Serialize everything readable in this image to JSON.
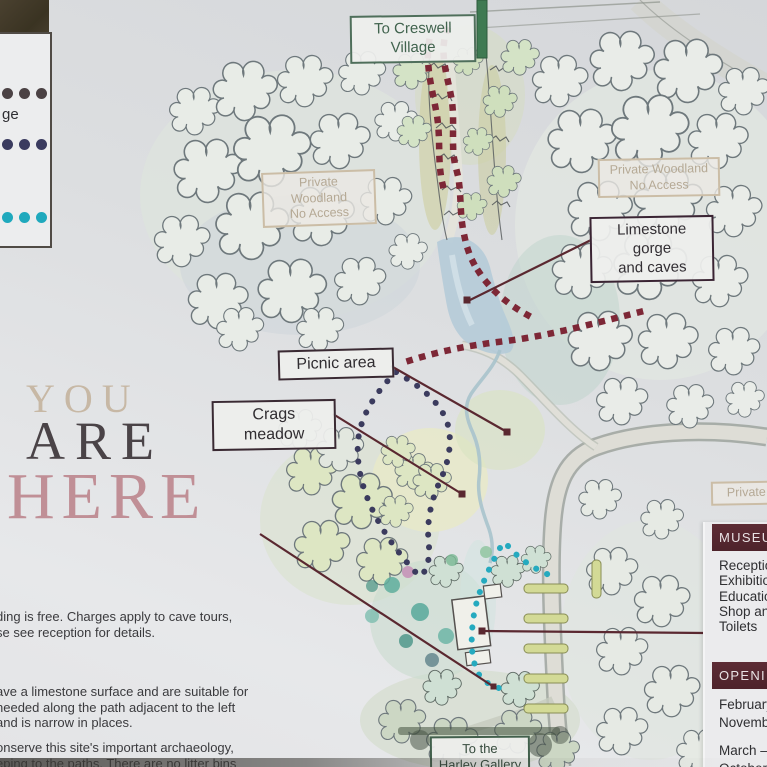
{
  "sign": {
    "you_are_here": {
      "line1": "YOU",
      "line2": "ARE",
      "line3": "HERE"
    },
    "legend": {
      "partial_label": "ge",
      "trails": [
        {
          "name": "limestone-gorge-trail",
          "dot_color": "#4b4244"
        },
        {
          "name": "meadow-trail",
          "dot_color": "#3a3b5f"
        },
        {
          "name": "waterside-trail",
          "dot_color": "#1fa9bd"
        }
      ]
    },
    "info_paragraphs": [
      {
        "lines": [
          "ding is free. Charges apply to cave tours,",
          "se see reception for details."
        ]
      },
      {
        "lines": [
          "ave a limestone surface and are suitable for",
          "needed along the path adjacent to the left",
          "and is narrow in places."
        ]
      },
      {
        "lines": [
          "onserve this site's important archaeology,",
          "eping to the paths. There are no litter bins"
        ]
      }
    ]
  },
  "map_labels": {
    "creswell_village": "To Creswell Village",
    "private_woodland": {
      "line1": "Private Woodland",
      "line2": "No Access"
    },
    "limestone_gorge": {
      "line1": "Limestone gorge",
      "line2": "and caves"
    },
    "picnic_area": "Picnic area",
    "crags_meadow": "Crags meadow",
    "private_partial": "Private Lo",
    "harley_gallery": {
      "line1": "To the",
      "line2": "Harley Gallery"
    }
  },
  "museum_panel": {
    "header": "MUSEUM",
    "items": [
      "Reception",
      "Exhibition",
      "Education",
      "Shop and",
      "Toilets"
    ]
  },
  "opening_panel": {
    "header": "OPENING",
    "lines": [
      "February –",
      "November",
      "March – S",
      "October –"
    ]
  },
  "colors": {
    "trail_gorge_dots": "#7d2736",
    "trail_meadow_dots": "#3b3b5e",
    "trail_waterside_dots": "#25aabf",
    "leader_line": "#5a2830",
    "label_green": "#41634e",
    "label_tan": "#b5a995",
    "panel_maroon": "#55272f",
    "lake": "#b5cbd8",
    "signpost_green": "#3f7a52"
  }
}
